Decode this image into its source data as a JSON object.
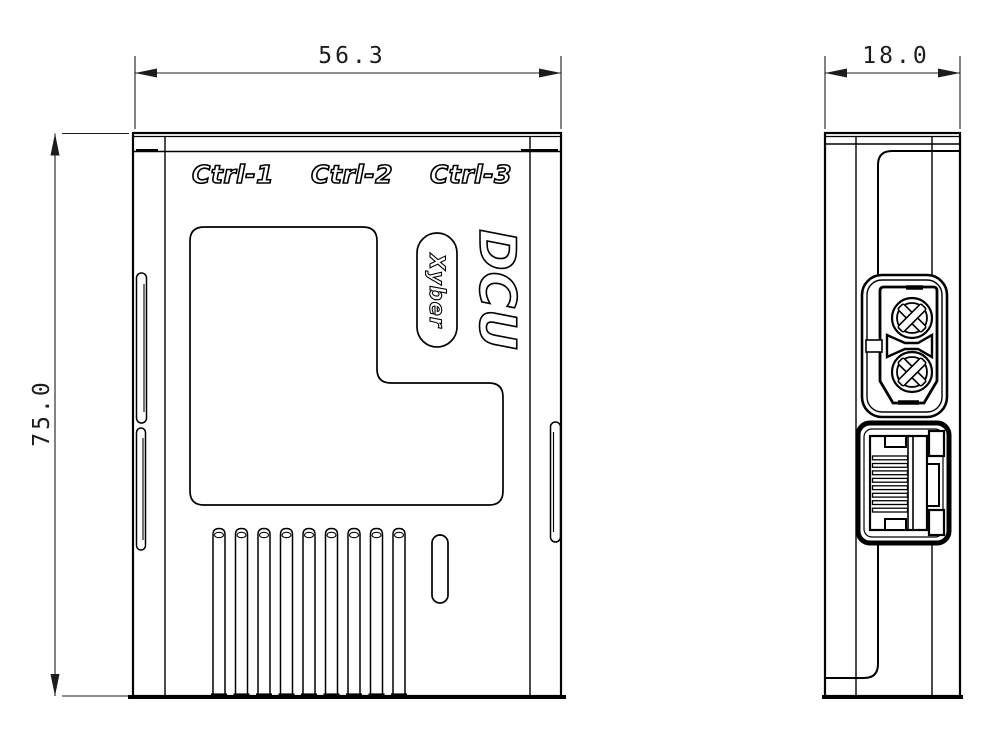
{
  "front_view": {
    "port_labels": [
      "Ctrl-1",
      "Ctrl-2",
      "Ctrl-3"
    ],
    "product_name": "DCU",
    "brand_name": "Xyber",
    "dimensions": {
      "width_mm": "56.3",
      "height_mm": "75.0"
    }
  },
  "side_view": {
    "dimensions": {
      "depth_mm": "18.0"
    }
  },
  "style": {
    "line_color": "#000000",
    "background_color": "#ffffff"
  }
}
